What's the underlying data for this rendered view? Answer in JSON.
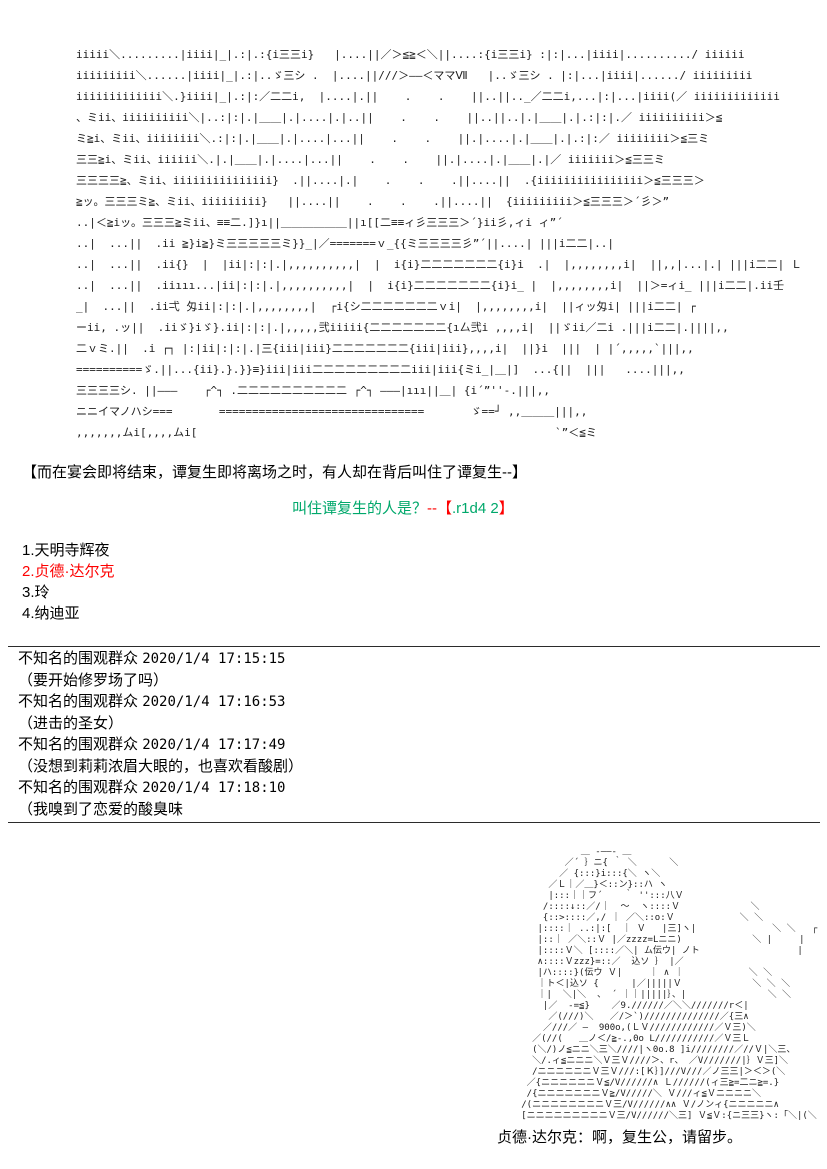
{
  "colors": {
    "background": "#ffffff",
    "text": "#000000",
    "ascii_art": "#1c1c1c",
    "question_green": "#00a86b",
    "question_red": "#fe0000",
    "highlight_red": "#fe0000"
  },
  "top_ascii_art": {
    "lines": [
      "iiiii＼.........|iiii|_|.:|.:{i三三i}   |....||／＞≦≧＜＼||....:{i三三i} :|:|...|iiii|........../ iiiiii",
      "iiiiiiiii＼......|iiii|_|.:|..ゞ三シ .  |....||///＞――＜ママⅦ   |..ゞ三シ . |:|...|iiii|....../ iiiiiiiii",
      "iiiiiiiiiiiii＼.}iiii|_|.:|:／二二i,  |....|.||    .    .    ||..||.._／二二i,...|:|...|iiii(／ iiiiiiiiiiiii",
      "、ミii、iiiiiiiiii＼|..:|:|.|＿＿|.|....|.|..||    .    .    ||..||..|.|＿＿|.|.:|:|.／ iiiiiiiiii＞≦",
      "ミ≧i、ミii、iiiiiiii＼.:|:|.|＿＿|.|....|...||    .    .    ||.|....|.|＿＿|.|.:|:／ iiiiiiii＞≦三ミ",
      "三三≧i、ミii、iiiiii＼.|.|＿＿|.|....|...||    .    .    ||.|....|.|＿＿|.|／ iiiiiii＞≦三三ミ",
      "三三三三≧、ミii、iiiiiiiiiiiiiii}  .||....|.|    .    .    .||....||  .{iiiiiiiiiiiiiiii＞≦三三三＞",
      "≧ッ。三三三ミ≧、ミii、iiiiiiiii}   ||....||    .    .    .||....||  {iiiiiiiii＞≦三三三＞´彡＞”",
      "..|＜≧iッ。三三三≧ミii、≡≡二.]}ı||＿＿＿＿＿＿||ı[[二≡≡ィ彡三三三＞´}ii彡,ィi ィ”´",
      "..|  ...||  .ii ≧}i≧}ミ三三三三三ミ}}_|／=======ｖ_{{ミ三三三三彡”´||....| |||i二二|..|",
      "..|  ...||  .ii{}  |  |ii|:|:|.|,,,,,,,,,,|  |  i{i}二二二二二二二{i}i  .|  |,,,,,,,,i|  ||,,|...|.| |||i二二| Ｌ",
      "..|  ...||  .iiııı...|ii|:|:|.|,,,,,,,,,,|  |  i{i}二二二二二二二{i}i_ |  |,,,,,,,,i|  ||＞=ィi_ |||i二二|.ii壬",
      "_|  ...||  .ii弌 匁ii|:|:|.|,,,,,,,,|  ┌i{シ二二二二二二二ｖi|  |,,,,,,,,i|  ||ィッ匁i| |||i二二| ┌",
      "ーii, .ッ||  .iiゞ}iゞ}.ii|:|:|.|,,,,,弐iiiii{二二二二二二二{ı厶弐i ,,,,i|  ||ゞii／二i .|||i二二|.||||,,",
      "二ｖミ.||  .i ┌┐ |:|ii|:|:|.|三{iii|iii}二二二二二二二{iii|iii},,,,i|  ||}i  |||  | |´,,,,,`|||,,",
      "==========ゞ.||...{ii}.}.}}≡}iii|iii二二二二二二二二二iii|iii{ミi_|＿|]  ...{||  |||   ....|||,,",
      "三三三三シ. ||―――    ┌^┐ .二二二二二二二二二二 ┌^┐ ―――|ııı||＿| {i´”''-.|||,,",
      "ニニイマノハシ===       ===============================       ゞ==┘ ,,＿＿＿|||,,",
      ",,,,,,,ムi[,,,,ムi[                                                      `”＜≦ミ"
    ]
  },
  "narration": {
    "text": "【而在宴会即将结束，谭复生即将离场之时，有人却在背后叫住了谭复生--】"
  },
  "question": {
    "part1_green": "叫住谭复生的人是？",
    "part2_red": "--【",
    "part3_green": ".r1d4 2",
    "part4_red": "】"
  },
  "options": {
    "items": [
      {
        "label": "1.天明寺辉夜",
        "highlight": false
      },
      {
        "label": "2.贞德·达尔克",
        "highlight": true
      },
      {
        "label": "3.玲",
        "highlight": false
      },
      {
        "label": "4.纳迪亚",
        "highlight": false
      }
    ]
  },
  "comments": {
    "items": [
      {
        "author": "不知名的围观群众",
        "timestamp": "2020/1/4 17:15:15",
        "message": "（要开始修罗场了吗）"
      },
      {
        "author": "不知名的围观群众",
        "timestamp": "2020/1/4 17:16:53",
        "message": "（进击的圣女）"
      },
      {
        "author": "不知名的围观群众",
        "timestamp": "2020/1/4 17:17:49",
        "message": "（没想到莉莉浓眉大眼的，也喜欢看酸剧）"
      },
      {
        "author": "不知名的围观群众",
        "timestamp": "2020/1/4 17:18:10",
        "message": "（我嗅到了恋爱的酸臭味"
      }
    ]
  },
  "bottom_ascii_art": {
    "lines": [
      "              ＿ -――- ＿",
      "           ／´ ｝ニ{ ｀ ＼      ＼",
      "          ／ {:::}i:::{＼ ヽ＼",
      "        ／Ｌ｜／＿}＜::ン}::ハ ヽ",
      "        |:::｜｜フ´    ｀ '':::八Ｖ",
      "       /::::↓::／/｜  ～  ヽ::::Ｖ             ＼",
      "       {::>::::／,/ ｜ ／＼::o:Ｖ            ＼ ＼",
      "      |::::｜ ..:|:[  ｜ Ｖ   |三]ヽ|              ＼ ＼   ┌",
      "      |::｜ ／＼::Ｖ |／zzzz=Lニニ)             ＼ |     |",
      "      |::::Ｖ＼ [::::／＼| ム伝ウ| ノト                  |",
      "      ∧::::Ｖzzz}=::／  込ソ ｝ |／",
      "      |ハ::::}(伝ウ Ｖ|     ｜ ∧ ｜            ＼ ＼",
      "      ｜ト＜|込ソ {      |／|||||Ｖ             ＼ ＼ ＼",
      "      ｜|  ＼|＼  、 ´ ｜｜|||||｝、|               ＼ ＼",
      "       |／  -=≦}    ／9.//////／＼＼///////r＜|",
      "        ／(///)＼   ／/＞`)//////////////／{三∧",
      "       ／///／ ―  900o,(ＬＶ////////////／Ｖ三)＼",
      "     ／(//(   ＿ノ＜/≧-.,0o L///////////／Ｖ三Ｌ",
      "     (＼/)ノ≦ニニ＼三＼////|ヽ0o.8 ]i////////／//Ｖ|＼三、",
      "     ＼/.ィ≦ニニニ＼Ｖ三Ｖ////＞、r、 ／V///////|｝Ｖ三]＼",
      "     /ニニニニニニＶ三Ｖ///:[Ｋ｝]///V///／ノ三三|＞＜＞(＼",
      "    ／{ニニニニニニＶ≦/V//////∧ Ｌ//////(ィ三≧=二ニ≧=.}",
      "    /{ニニニニニニニＶ≧/V/////＼ Ｖ///ィ≦Ｖニニニニ＼",
      "   /(ニニニニニニニニＶ三/V//////∧∧ Ｖ/ノンィ{ニニニニニ∧",
      "   [ニニニニニニニニニＶ三/V//////＼三] Ｖ≦Ｖ:{ニ三三}ヽ:「＼|(＼"
    ]
  },
  "caption": {
    "text": "贞德·达尔克：啊，复生公，请留步。"
  }
}
